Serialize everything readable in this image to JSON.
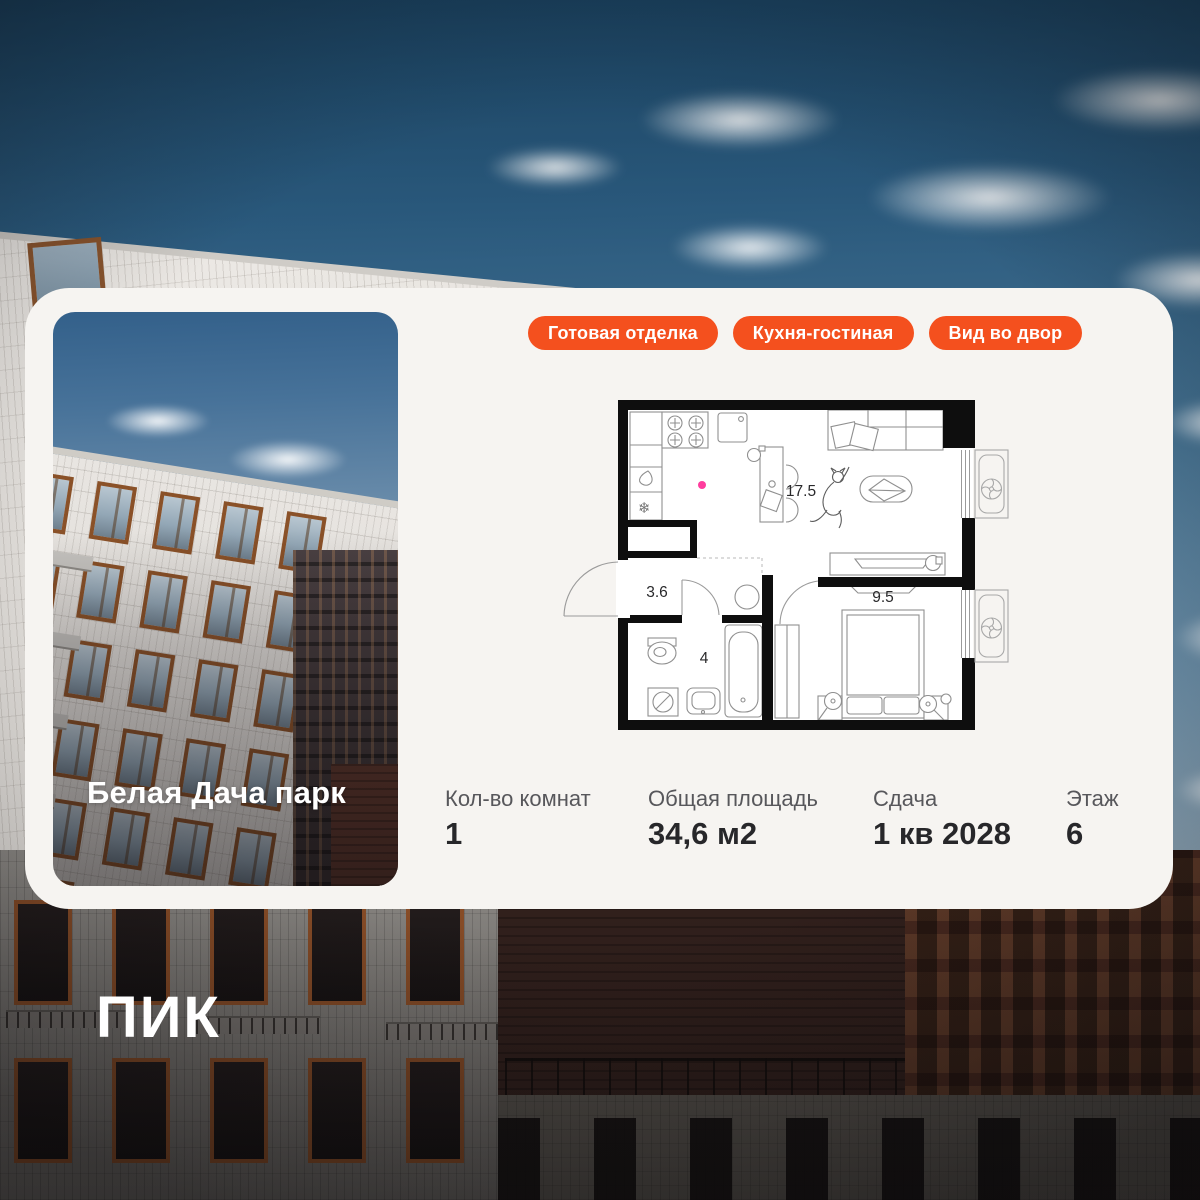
{
  "card": {
    "project_label": "Белая Дача парк",
    "badge_color": "#F4501E",
    "badges": [
      {
        "label": "Готовая отделка"
      },
      {
        "label": "Кухня-гостиная"
      },
      {
        "label": "Вид во двор"
      }
    ],
    "stats": [
      {
        "label": "Кол-во комнат",
        "value": "1"
      },
      {
        "label": "Общая площадь",
        "value": "34,6 м2"
      },
      {
        "label": "Сдача",
        "value": "1 кв 2028"
      },
      {
        "label": "Этаж",
        "value": "6"
      }
    ],
    "floorplan": {
      "rooms": [
        {
          "name": "kitchen-living",
          "area_label": "17.5"
        },
        {
          "name": "hallway",
          "area_label": "3.6"
        },
        {
          "name": "bathroom",
          "area_label": "4"
        },
        {
          "name": "bedroom",
          "area_label": "9.5"
        }
      ],
      "marker_dot_color": "#FF3D9E",
      "icons": [
        "snowflake-icon",
        "fan-icon",
        "fan-icon"
      ],
      "snowflake_glyph": "❄"
    }
  },
  "footer": {
    "logo": "ПИК"
  }
}
